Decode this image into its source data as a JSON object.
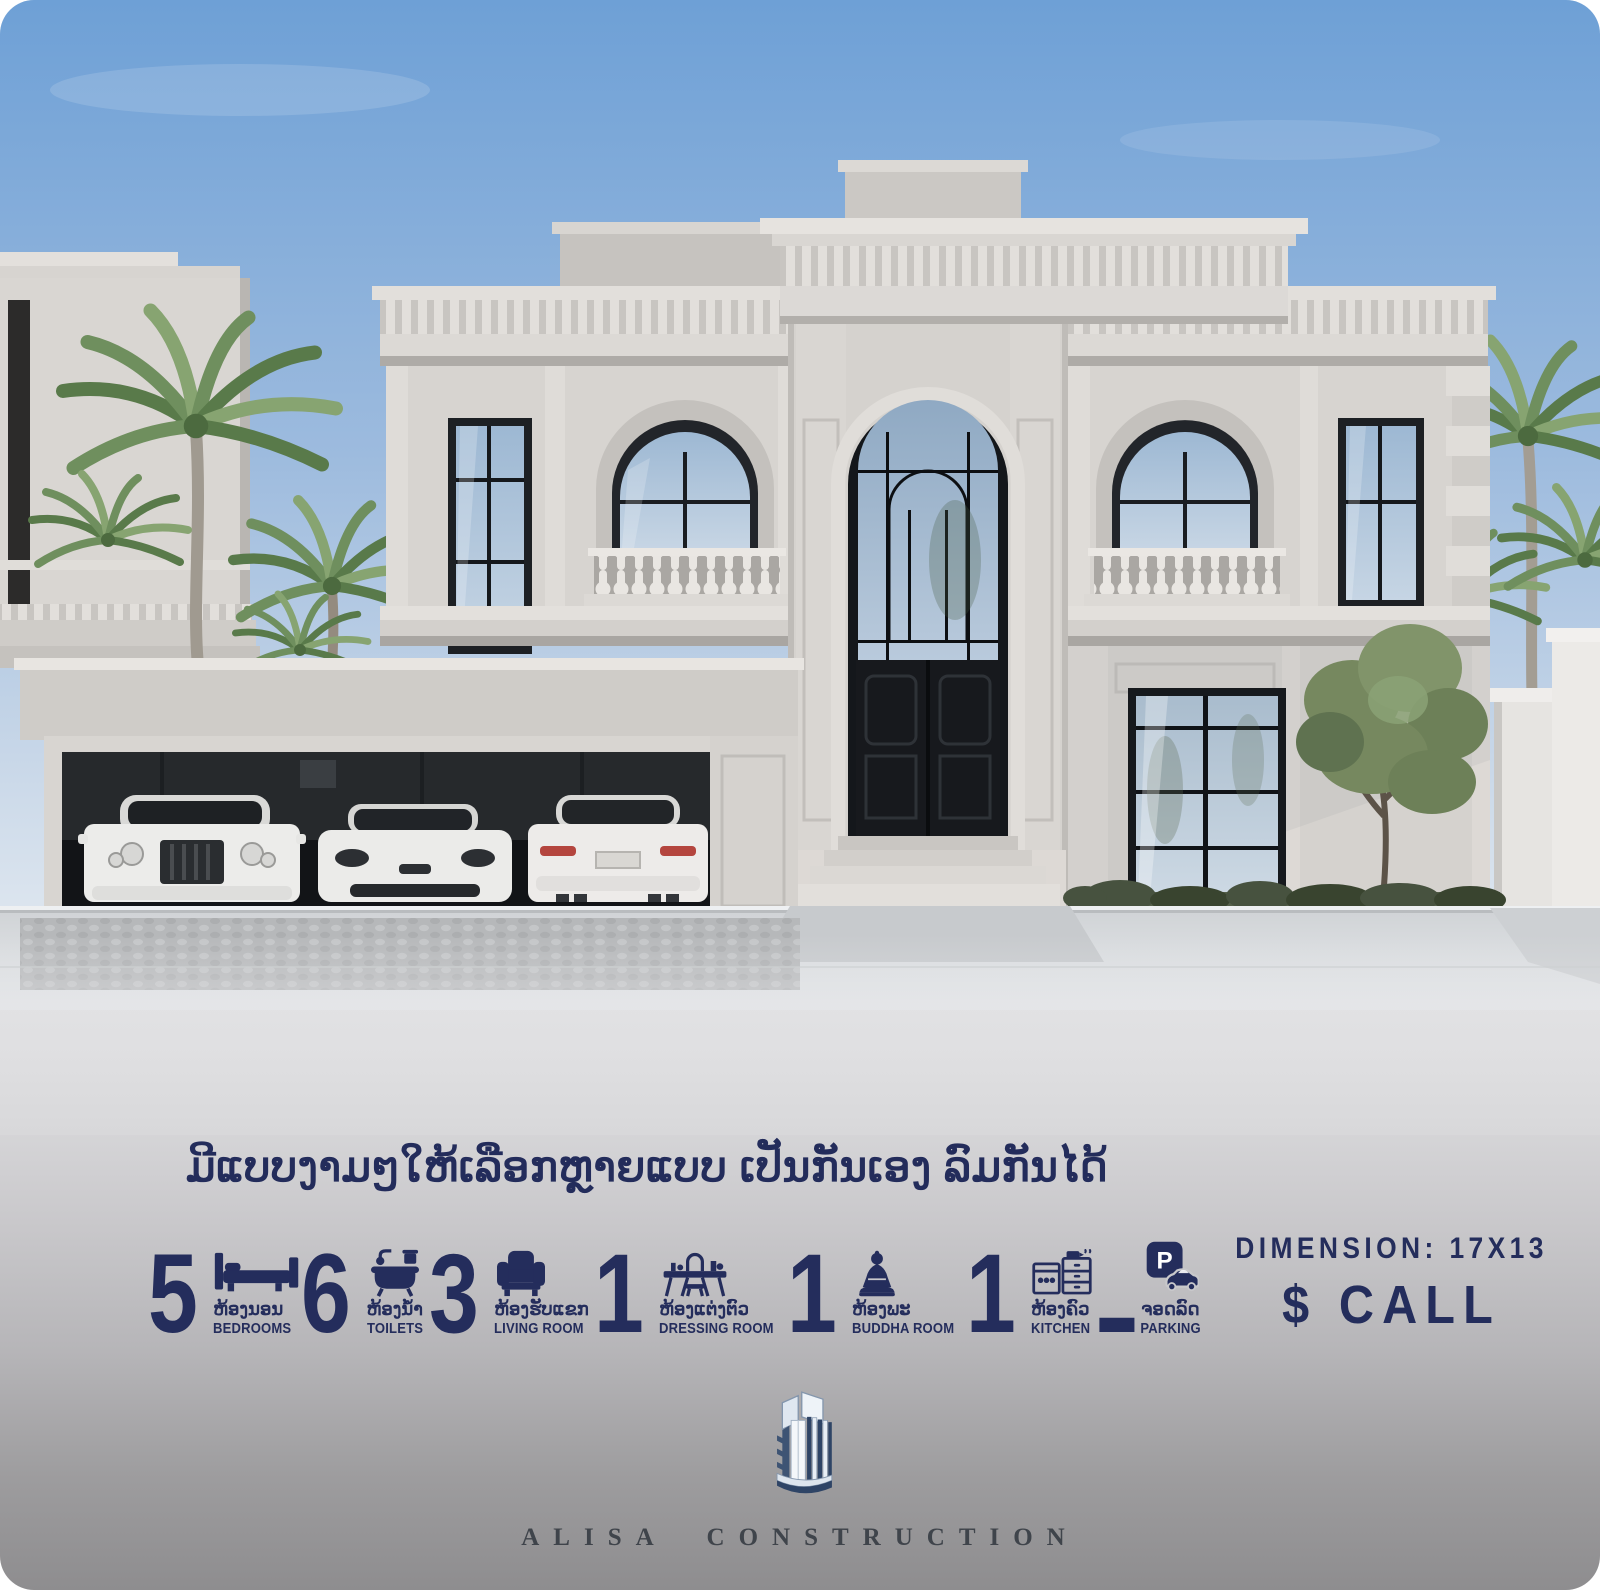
{
  "headline": {
    "text": "ມີແບບງາມໆໃຫ້ເລືອກຫຼາຍແບບ ເປັນກັນເອງ ລົມກັນໄດ້"
  },
  "stats": [
    {
      "value": "5",
      "icon": "bed-icon",
      "label_lo": "ຫ້ອງນອນ",
      "label_en": "BEDROOMS"
    },
    {
      "value": "6",
      "icon": "bathtub-icon",
      "label_lo": "ຫ້ອງນ້ຳ",
      "label_en": "TOILETS"
    },
    {
      "value": "3",
      "icon": "armchair-icon",
      "label_lo": "ຫ້ອງຮັບແຂກ",
      "label_en": "LIVING ROOM"
    },
    {
      "value": "1",
      "icon": "dressing-table-icon",
      "label_lo": "ຫ້ອງແຕ່ງຕົວ",
      "label_en": "DRESSING ROOM"
    },
    {
      "value": "1",
      "icon": "buddha-icon",
      "label_lo": "ຫ້ອງພະ",
      "label_en": "BUDDHA ROOM"
    },
    {
      "value": "1",
      "icon": "kitchen-icon",
      "label_lo": "ຫ້ອງຄົວ",
      "label_en": "KITCHEN"
    }
  ],
  "separator": {
    "glyph": "-"
  },
  "parking": {
    "icon": "parking-icon",
    "sign_letter": "P",
    "label_lo": "ຈອດລົດ",
    "label_en": "PARKING"
  },
  "dimension": {
    "label": "DIMENSION: 17X13"
  },
  "price": {
    "label": "$ CALL"
  },
  "brand": {
    "name": "ALISA CONSTRUCTION"
  },
  "colors": {
    "accent_navy": "#242d5c",
    "panel_top": "#e6e7e9",
    "panel_bottom": "#8e8d8f",
    "sky_top": "#6ea0d6",
    "sky_horizon": "#e9eef3",
    "stone_light": "#e2dfdb",
    "stone": "#d6d3cf",
    "stone_shadow": "#aeaba7",
    "dark_window": "#16191d",
    "palm_green": "#6f8f5e",
    "brand_text": "#3f444b"
  }
}
